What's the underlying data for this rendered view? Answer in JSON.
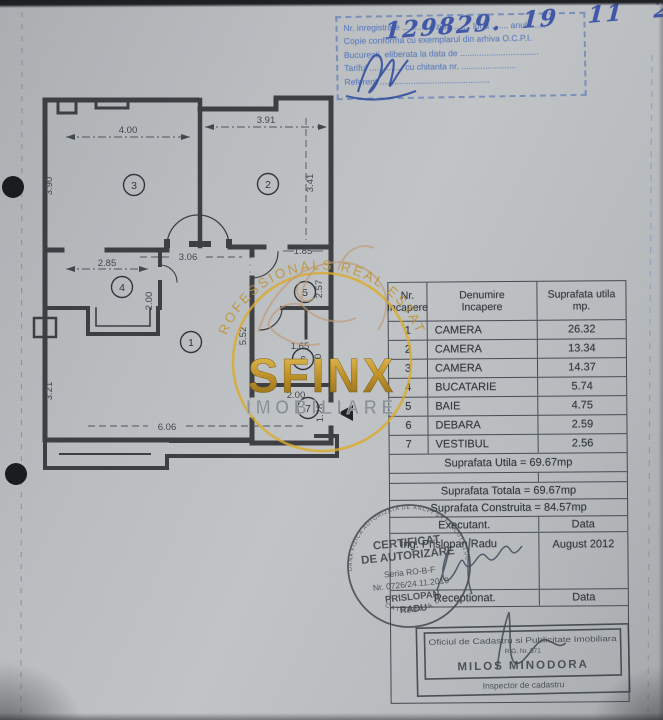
{
  "registration_stamp": {
    "handwritten_number": "129829.  19   11   2024.",
    "line_registration": "Nr. inregistrare ............. ziua ....... luna ....... anul .......",
    "line_copy": "Copie conforma cu exemplarul din arhiva O.C.P.I.",
    "line_city": "Bucuresti, eliberata la data de .................................",
    "line_fee": "Tariful .............. cu chitanta nr. .......................",
    "line_referent": "Referent ..............................................",
    "ink_color": "#3a53ab",
    "stamp_color": "#6181c1"
  },
  "floor_plan": {
    "room_numbers": [
      "1",
      "2",
      "3",
      "4",
      "5",
      "6",
      "7"
    ],
    "dimensions": {
      "room3_width": "4.00",
      "room2_width": "3.91",
      "room3_height": "3.90",
      "room2_height": "3.41",
      "hall_width": "3.06",
      "bath_width": "1.85",
      "kitchen_width": "2.85",
      "kitchen_height": "2.00",
      "bath_height": "2.57",
      "right_column_height": "5.52",
      "storage_width": "1.65",
      "storage_height": "1.70",
      "vestibule_width": "2.00",
      "vestibule_height": "1.28",
      "room1_height": "3.21",
      "room1_width": "6.06"
    }
  },
  "watermark": {
    "arc_text": "PROFESSIONALS REAL ESTATE",
    "name": "SFINX",
    "subtitle": "IMOBILIARE",
    "gold_color": "#c89522"
  },
  "area_table": {
    "headers": {
      "col1_line1": "Nr.",
      "col1_line2": "Incapere",
      "col2_line1": "Denumire",
      "col2_line2": "Incapere",
      "col3_line1": "Suprafata utila",
      "col3_line2": "mp."
    },
    "rows": [
      {
        "nr": "1",
        "name": "CAMERA",
        "area": "26.32"
      },
      {
        "nr": "2",
        "name": "CAMERA",
        "area": "13.34"
      },
      {
        "nr": "3",
        "name": "CAMERA",
        "area": "14.37"
      },
      {
        "nr": "4",
        "name": "BUCATARIE",
        "area": "5.74"
      },
      {
        "nr": "5",
        "name": "BAIE",
        "area": "4.75"
      },
      {
        "nr": "6",
        "name": "DEBARA",
        "area": "2.59"
      },
      {
        "nr": "7",
        "name": "VESTIBUL",
        "area": "2.56"
      }
    ],
    "suprafata_utila": "Suprafata Utila = 69.67mp",
    "suprafata_totala": "Suprafata Totala = 69.67mp",
    "suprafata_construita": "Suprafata Construita = 84.57mp",
    "executant_label": "Executant.",
    "data_label": "Data",
    "executant_name": "Ing. Prislopan Radu",
    "executant_date": "August 2012",
    "receptionat_label": "Receptionat."
  },
  "certificate_stamp": {
    "ring_text": "PERSOANA FIZICA AUTORIZATA DE ANCPI SA EXECUTE LUCRARI",
    "category": "CATEGORIA D",
    "line1": "CERTIFICAT",
    "line2": "DE AUTORIZARE",
    "line3": "Seria RO-B-F",
    "line4": "Nr. 0726/24.11.2010",
    "line5": "PRISLOPAN",
    "line6": "RADU"
  },
  "office_stamp": {
    "title": "Oficiul de Cadastru si Publicitate Imobiliara",
    "subtitle": "R.G. Nr. 571",
    "name": "MILOS MINODORA",
    "role": "Inspector de cadastru"
  }
}
